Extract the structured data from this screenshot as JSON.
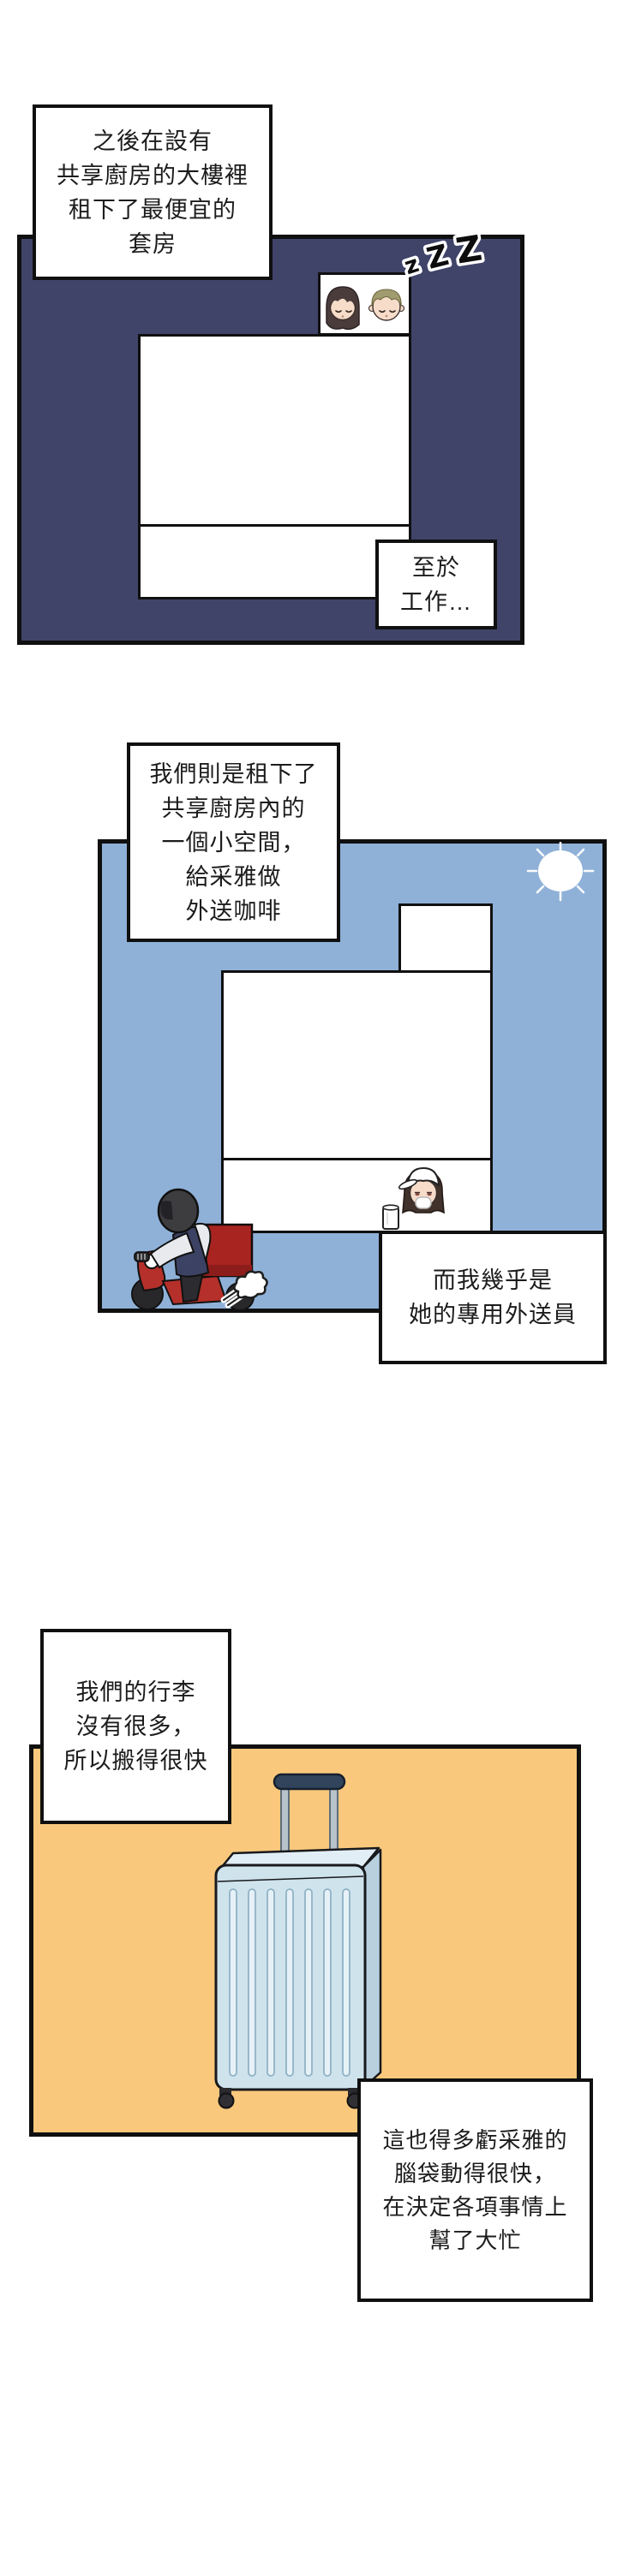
{
  "page": {
    "background": "#ffffff"
  },
  "colors": {
    "panel1_bg": "#404469",
    "panel2_bg": "#8fb1d8",
    "panel3_bg": "#f9c87c",
    "box_border": "#101010",
    "delivery_red": "#a82420",
    "suitcase_blue": "#cfe3ed"
  },
  "panel1": {
    "narration_box": "之後在設有\n共享廚房的大樓裡\n租下了最便宜的\n套房",
    "zzz": {
      "z1": "z",
      "z2": "Z",
      "z3": "Z"
    },
    "caption_box": "至於\n工作…"
  },
  "panel2": {
    "narration_box": "我們則是租下了\n共享廚房內的\n一個小空間，\n給采雅做\n外送咖啡",
    "caption_box": "而我幾乎是\n她的專用外送員"
  },
  "panel3": {
    "narration_box": "我們的行李\n沒有很多，\n所以搬得很快",
    "caption_box": "這也得多虧采雅的\n腦袋動得很快，\n在決定各項事情上\n幫了大忙"
  },
  "illustrations": [
    "sleeping-couple-illustration",
    "zzz-icon",
    "sun-icon",
    "barista-character",
    "coffee-cup-icon",
    "delivery-rider-illustration",
    "exhaust-puff-icon",
    "suitcase-illustration"
  ]
}
